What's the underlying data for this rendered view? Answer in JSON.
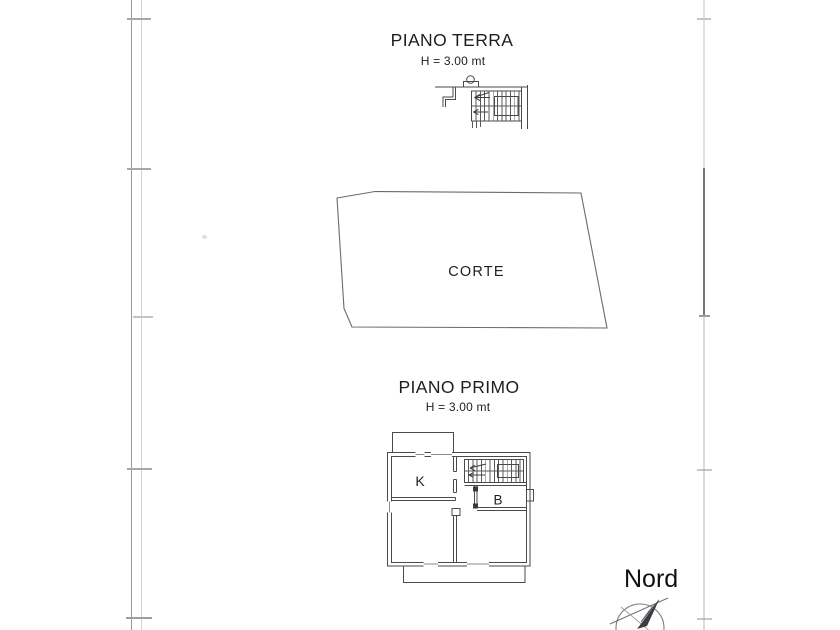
{
  "page": {
    "background": "#ffffff",
    "ink_color": "#454545",
    "border_line_color": "#97979d",
    "border_tick_color": "#a6a6ac"
  },
  "ground_floor": {
    "title": "PIANO TERRA",
    "height_note": "H = 3.00 mt"
  },
  "courtyard": {
    "label": "CORTE"
  },
  "first_floor": {
    "title": "PIANO PRIMO",
    "height_note": "H = 3.00 mt",
    "rooms": [
      {
        "label": "K"
      },
      {
        "label": "B"
      }
    ]
  },
  "compass": {
    "label": "Nord"
  }
}
